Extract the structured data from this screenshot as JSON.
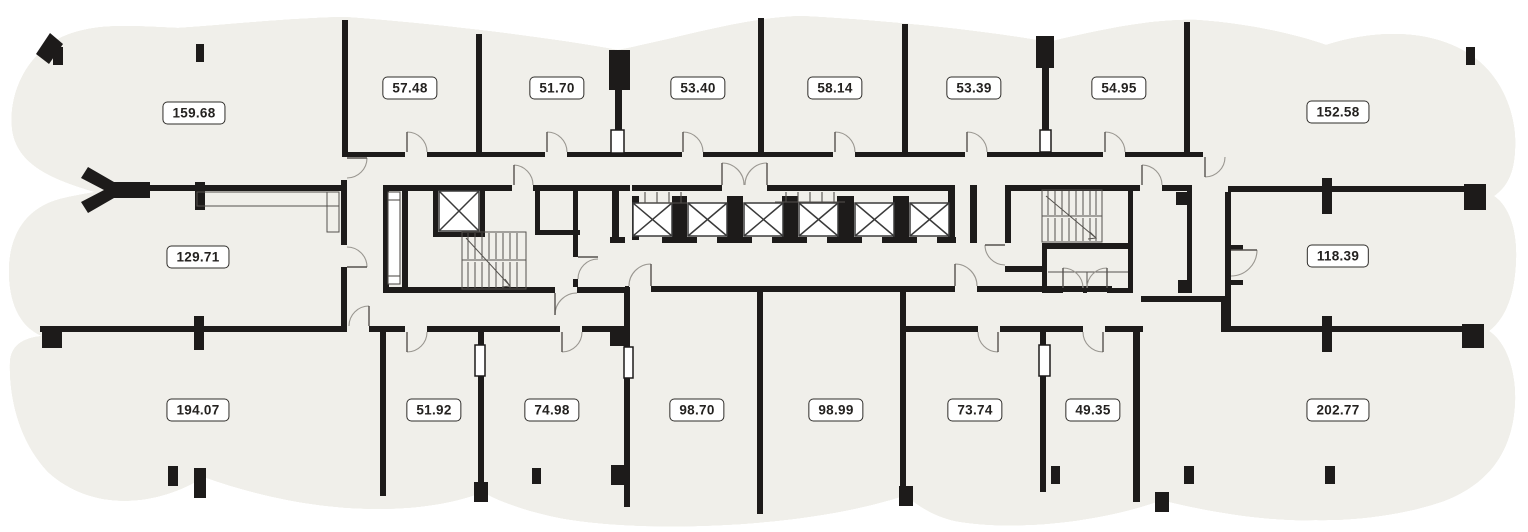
{
  "plan": {
    "title": "floor-plan",
    "watermark": "Group",
    "rooms": [
      {
        "area": "159.68"
      },
      {
        "area": "57.48"
      },
      {
        "area": "51.70"
      },
      {
        "area": "53.40"
      },
      {
        "area": "58.14"
      },
      {
        "area": "53.39"
      },
      {
        "area": "54.95"
      },
      {
        "area": "152.58"
      },
      {
        "area": "129.71"
      },
      {
        "area": "118.39"
      },
      {
        "area": "194.07"
      },
      {
        "area": "51.92"
      },
      {
        "area": "74.98"
      },
      {
        "area": "98.70"
      },
      {
        "area": "98.99"
      },
      {
        "area": "73.74"
      },
      {
        "area": "49.35"
      },
      {
        "area": "202.77"
      }
    ],
    "colors": {
      "room_fill": "#f0efea",
      "wall": "#1d1b1a",
      "glazing_line": "#8f8c86",
      "label_border": "#2e2c29",
      "label_text": "#242220",
      "watermark": "#eae8e3"
    }
  }
}
